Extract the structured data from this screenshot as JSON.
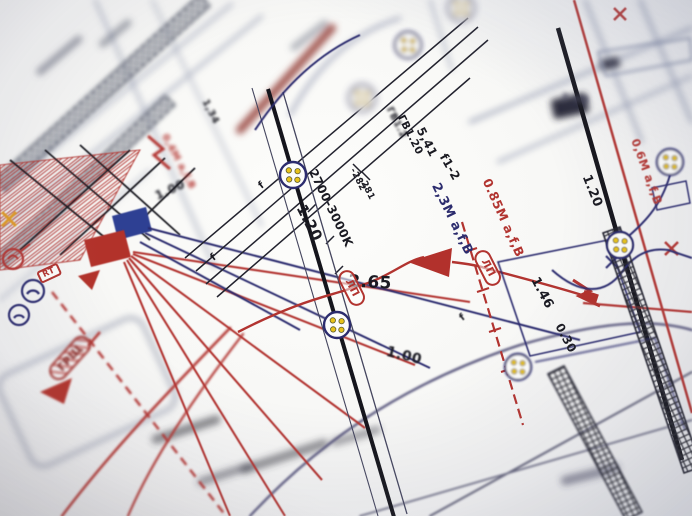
{
  "scene": {
    "description": "Angled close-up photograph of a printed electrical wiring plan; sharp focus in the centre, strong depth-of-field blur toward the corners.",
    "colors": {
      "paper": "#fbfbf9",
      "ink_black": "#1a1a22",
      "ink_navy": "#2c2c6e",
      "ink_red": "#b23430",
      "dot_yellow": "#e8c31a",
      "blur_gray": "#9aa0b5"
    },
    "symbols": [
      {
        "name": "luminaire-group-symbol",
        "shape": "circle with four yellow dots",
        "count": 8
      },
      {
        "name": "junction-box-blue",
        "shape": "filled navy parallelogram"
      },
      {
        "name": "junction-box-red",
        "shape": "filled red parallelogram"
      },
      {
        "name": "flow-arrow",
        "shape": "filled red triangle"
      },
      {
        "name": "lightning-bolt-icon",
        "shape": "red zigzag",
        "count": 2
      },
      {
        "name": "cable-tray-band",
        "shape": "cross-hatched ladder strip",
        "count": 4
      },
      {
        "name": "telephone-outlet-icon",
        "shape": "circle with handset",
        "count": 2
      }
    ]
  },
  "labels": [
    {
      "id": "dim-2-65",
      "text": "2.65",
      "x": 370,
      "y": 283,
      "rot": 3,
      "size": 17
    },
    {
      "id": "dim-1-20-center",
      "text": "1.20",
      "x": 309,
      "y": 223,
      "rot": 63,
      "size": 15
    },
    {
      "id": "lamp-temp-range",
      "text": "2700-3000K",
      "x": 331,
      "y": 208,
      "rot": 64,
      "size": 12
    },
    {
      "id": "elev-282",
      "text": "-282",
      "x": 357,
      "y": 180,
      "rot": 63,
      "size": 9
    },
    {
      "id": "elev-281",
      "text": "-281",
      "x": 366,
      "y": 189,
      "rot": 63,
      "size": 9
    },
    {
      "id": "gv-1-2",
      "text": "ГВ1.2",
      "x": 396,
      "y": 123,
      "rot": 63,
      "size": 10,
      "blur": 1.2
    },
    {
      "id": "gv-1-20",
      "text": "ГВ1.20",
      "x": 410,
      "y": 135,
      "rot": 63,
      "size": 10.5
    },
    {
      "id": "dim-5-41",
      "text": "5,41",
      "x": 427,
      "y": 142,
      "rot": 63,
      "size": 12
    },
    {
      "id": "circuit-f1-2",
      "text": "f1-2",
      "x": 450,
      "y": 167,
      "rot": 60,
      "size": 12
    },
    {
      "id": "cable-2-3m",
      "text": "2,3M a,f,B",
      "x": 452,
      "y": 219,
      "rot": 64,
      "size": 13,
      "color": "#2c2c6e"
    },
    {
      "id": "cable-0-85m",
      "text": "0.85M a,f,B",
      "x": 503,
      "y": 218,
      "rot": 66,
      "size": 12.5,
      "color": "#b23430"
    },
    {
      "id": "cable-0-6m",
      "text": "0,6M a,f,B",
      "x": 646,
      "y": 172,
      "rot": 70,
      "size": 11.5,
      "color": "#b23430",
      "blur": 0.4
    },
    {
      "id": "cable-0-4m",
      "text": "0,4M a,f,B",
      "x": 178,
      "y": 162,
      "rot": 62,
      "size": 10,
      "color": "#b23430",
      "blur": 1.8
    },
    {
      "id": "dim-1-20-right",
      "text": "1.20",
      "x": 592,
      "y": 191,
      "rot": 68,
      "size": 13
    },
    {
      "id": "dim-1-46",
      "text": "1.46",
      "x": 542,
      "y": 293,
      "rot": 62,
      "size": 13
    },
    {
      "id": "dim-0-30",
      "text": "0.30",
      "x": 566,
      "y": 338,
      "rot": 62,
      "size": 12
    },
    {
      "id": "dim-1-00-center",
      "text": "1.00",
      "x": 404,
      "y": 356,
      "rot": 14,
      "size": 14,
      "blur": 0.8
    },
    {
      "id": "dim-1-00-left",
      "text": "1.00",
      "x": 170,
      "y": 190,
      "rot": -25,
      "size": 12,
      "blur": 1.2
    },
    {
      "id": "dim-1-34",
      "text": "1,34",
      "x": 210,
      "y": 112,
      "rot": 63,
      "size": 10,
      "blur": 1.2
    },
    {
      "id": "dim-3-48",
      "text": "3 48",
      "x": 575,
      "y": 99,
      "rot": 8,
      "size": 11,
      "blur": 2.5,
      "color": "#44445a"
    },
    {
      "id": "lp-tag-left",
      "text": "ЛП",
      "x": 352,
      "y": 288,
      "rot": 63,
      "size": 10.5,
      "color": "#b23430",
      "frame": "stadium"
    },
    {
      "id": "lp-tag-right",
      "text": "ЛП",
      "x": 488,
      "y": 268,
      "rot": 63,
      "size": 10.5,
      "color": "#b23430",
      "frame": "stadium"
    },
    {
      "id": "rt-tag",
      "text": "RT",
      "x": 49,
      "y": 273,
      "rot": -25,
      "size": 8.5,
      "color": "#b23430",
      "frame": "box"
    },
    {
      "id": "grshch-tag",
      "text": "ГРЩ",
      "x": 70,
      "y": 358,
      "rot": -48,
      "size": 11,
      "color": "#7e1f1b",
      "frame": "flag",
      "blur": 1.2
    },
    {
      "id": "f-mark-1",
      "text": "f",
      "x": 214,
      "y": 258,
      "rot": -38,
      "size": 10
    },
    {
      "id": "f-mark-2",
      "text": "f",
      "x": 262,
      "y": 186,
      "rot": -38,
      "size": 10
    },
    {
      "id": "f-mark-3",
      "text": "f",
      "x": 463,
      "y": 318,
      "rot": -38,
      "size": 10,
      "blur": 0.6
    }
  ]
}
